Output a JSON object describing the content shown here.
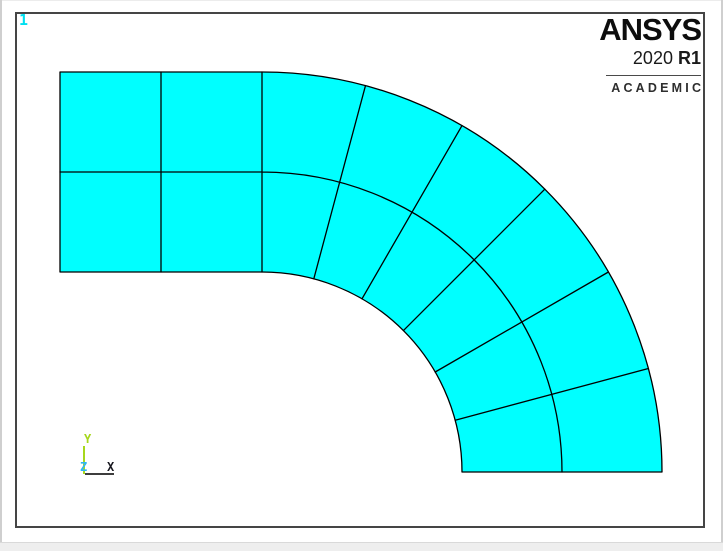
{
  "window": {
    "number_label": "1",
    "colors": {
      "outer_border": "#cfcfcf",
      "outer_border_light": "#ececec",
      "strip": "#eeeeee",
      "strip_line": "#d9d9d9",
      "frame_border": "#454545",
      "window_number": "#00dff0"
    }
  },
  "logo": {
    "brand": "ANSYS",
    "release_version": "2020",
    "release_tag": "R1",
    "edition": "ACADEMIC",
    "ink": "#0d0d0d",
    "edition_ink": "#2e2e2e"
  },
  "triad": {
    "y_label": "Y",
    "z_label": "Z",
    "x_label": "X",
    "y_color": "#a6d71c",
    "z_color": "#2fb6f2",
    "x_label_color": "#16161e",
    "x_axis_color": "#3d3d3d"
  },
  "mesh": {
    "description": "2D quad mesh of 90-degree elbow: straight 2x2 section plus quarter-annulus bend 6x2",
    "fill": "#00ffff",
    "edge": "#000000",
    "edge_width": 1.3,
    "center": {
      "x": 262,
      "y": 472
    },
    "inner_radius": 200,
    "outer_radius": 400,
    "sweep_deg": 90,
    "angular_divisions": 6,
    "radial_divisions": 2,
    "straight": {
      "x0": 60,
      "y0": 72,
      "x1": 262,
      "y1": 272,
      "cols": 2,
      "rows": 2
    }
  }
}
